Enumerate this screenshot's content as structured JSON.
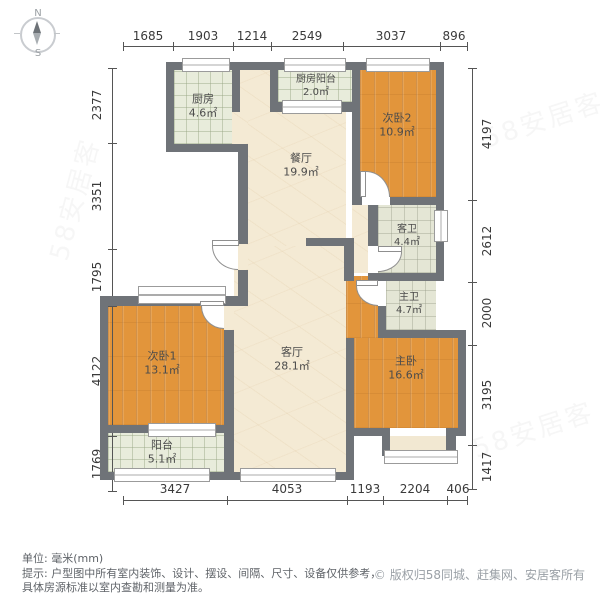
{
  "compass": {
    "north": "N",
    "south": "S"
  },
  "rooms": [
    {
      "id": "kitchen",
      "name": "厨房",
      "area": "4.6㎡"
    },
    {
      "id": "kitchen-balcony",
      "name": "厨房阳台",
      "area": "2.0㎡"
    },
    {
      "id": "bedroom2",
      "name": "次卧2",
      "area": "10.9㎡"
    },
    {
      "id": "dining",
      "name": "餐厅",
      "area": "19.9㎡"
    },
    {
      "id": "guest-bath",
      "name": "客卫",
      "area": "4.4㎡"
    },
    {
      "id": "master-bath",
      "name": "主卫",
      "area": "4.7㎡"
    },
    {
      "id": "bedroom1",
      "name": "次卧1",
      "area": "13.1㎡"
    },
    {
      "id": "living",
      "name": "客厅",
      "area": "28.1㎡"
    },
    {
      "id": "master-bedroom",
      "name": "主卧",
      "area": "16.6㎡"
    },
    {
      "id": "balcony",
      "name": "阳台",
      "area": "5.1㎡"
    }
  ],
  "dims": {
    "top": [
      "1685",
      "1903",
      "1214",
      "2549",
      "3037",
      "896"
    ],
    "left": [
      "2377",
      "3351",
      "1795",
      "4122",
      "1769"
    ],
    "right": [
      "4197",
      "2612",
      "2000",
      "3195",
      "1417"
    ],
    "bottom": [
      "3427",
      "4053",
      "1193",
      "2204",
      "406"
    ]
  },
  "notes": {
    "unit": "单位: 毫米(mm)",
    "tip_line1": "提示: 户型图中所有室内装饰、设计、摆设、间隔、尺寸、设备仅供参考，",
    "tip_line2": "具体房源标准以室内查勘和测量为准。"
  },
  "copyright": {
    "symbol": "©",
    "text": "版权归58同城、赶集网、安居客所有"
  },
  "watermark": {
    "text": "58安居客"
  },
  "colors": {
    "wall": "#6F7378",
    "wood": "#E2953B",
    "tile": "#E8ECDB",
    "bath": "#E4E6D5",
    "beige": "#F4EAD4"
  }
}
